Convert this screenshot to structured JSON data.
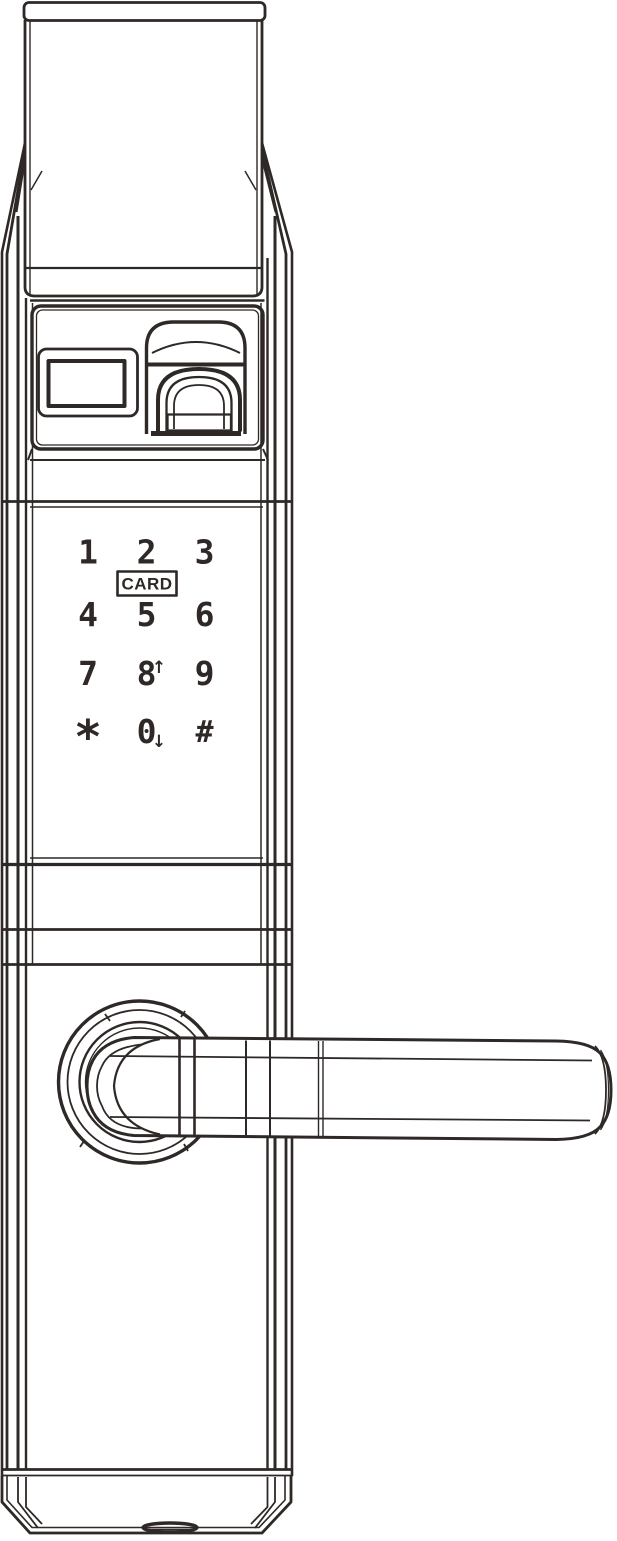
{
  "drawing": {
    "line_color": "#2e2826",
    "background_color": "#ffffff"
  },
  "keypad": {
    "card_badge": {
      "label": "CARD"
    },
    "keys": [
      {
        "label": "1"
      },
      {
        "label": "2"
      },
      {
        "label": "3"
      },
      {
        "label": "4"
      },
      {
        "label": "5"
      },
      {
        "label": "6"
      },
      {
        "label": "7"
      },
      {
        "label": "8",
        "arrow": "↑"
      },
      {
        "label": "9"
      },
      {
        "label": "*"
      },
      {
        "label": "0",
        "arrow": "↓"
      },
      {
        "label": "#"
      }
    ]
  }
}
